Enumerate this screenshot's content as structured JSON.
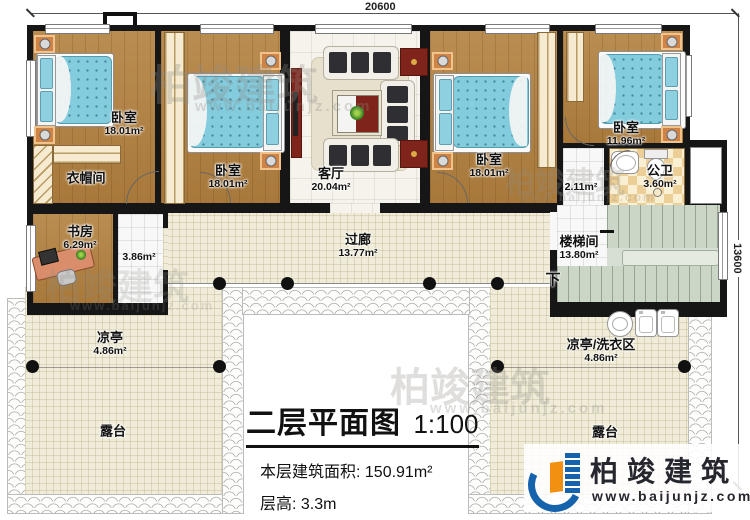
{
  "dims": {
    "top": "20600",
    "right": "13600"
  },
  "title": {
    "name": "二层平面图",
    "scale": "1:100",
    "area_line": "本层建筑面积: 150.91m²",
    "height_line": "层高: 3.3m"
  },
  "rooms": {
    "br1": {
      "label": "卧室",
      "area": "18.01m²"
    },
    "cloak": {
      "label": "衣帽间"
    },
    "br2": {
      "label": "卧室",
      "area": "18.01m²"
    },
    "living": {
      "label": "客厅",
      "area": "20.04m²"
    },
    "br3": {
      "label": "卧室",
      "area": "18.01m²"
    },
    "br4": {
      "label": "卧室",
      "area": "11.96m²"
    },
    "study": {
      "label": "书房",
      "area": "6.29m²"
    },
    "passage": {
      "area": "3.86m²"
    },
    "corridor": {
      "label": "过廊",
      "area": "13.77m²"
    },
    "hall": {
      "area": "2.11m²"
    },
    "bath": {
      "label": "公卫",
      "area": "3.60m²"
    },
    "stairwell": {
      "label": "楼梯间",
      "area": "13.80m²"
    },
    "pavilion_left": {
      "label": "凉亭",
      "area": "4.86m²"
    },
    "terrace_left": {
      "label": "露台"
    },
    "pavilion_right": {
      "label": "凉亭/洗衣区",
      "area": "4.86m²"
    },
    "terrace_right": {
      "label": "露台"
    }
  },
  "stairs": {
    "down": "下"
  },
  "watermark": {
    "brand": "柏竣建筑",
    "url": "www.baijunjz.com"
  },
  "logo": {
    "brand": "柏竣建筑",
    "url": "www.baijunjz.com"
  }
}
